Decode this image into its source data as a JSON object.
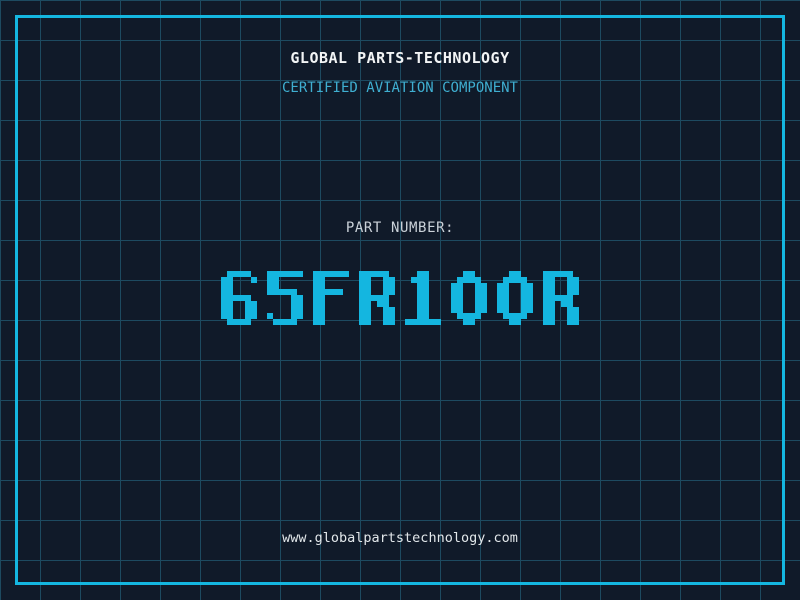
{
  "header": {
    "title": "GLOBAL PARTS-TECHNOLOGY",
    "subtitle": "CERTIFIED AVIATION COMPONENT"
  },
  "part": {
    "label": "PART NUMBER:",
    "value": "65FR100R"
  },
  "footer": {
    "url": "www.globalpartstechnology.com"
  },
  "colors": {
    "background": "#101a29",
    "grid_line": "#1d4a60",
    "accent_cyan": "#14b6e0",
    "subtitle_cyan": "#3fafd1",
    "title_white": "#f2f4f5",
    "label_gray": "#cbd2d9",
    "url_white": "#e2e7ea"
  }
}
